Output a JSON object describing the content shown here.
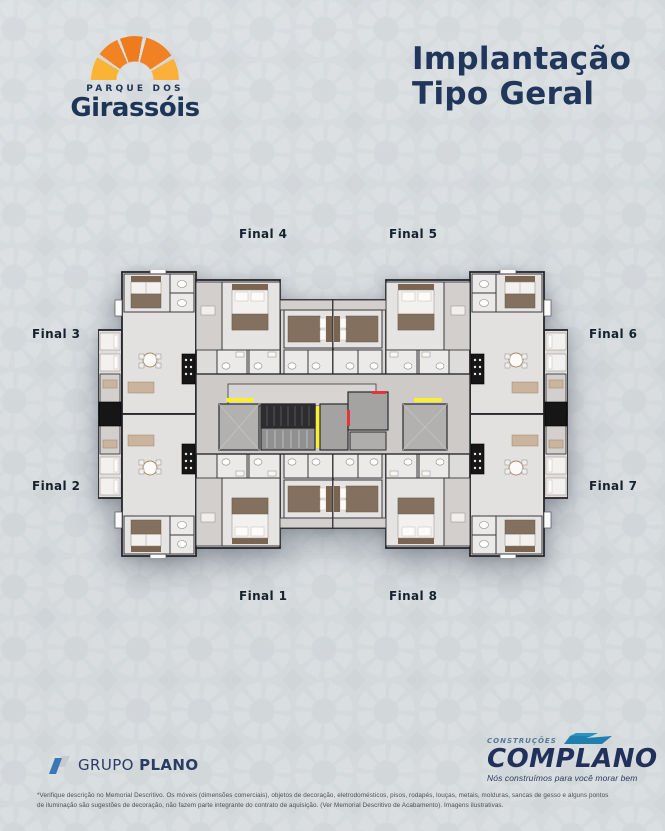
{
  "brand": {
    "top_label": "PARQUE DOS",
    "name": "Girassóis"
  },
  "title": {
    "line1": "Implantação",
    "line2": "Tipo Geral"
  },
  "plan_labels": {
    "final1": "Final 1",
    "final2": "Final 2",
    "final3": "Final 3",
    "final4": "Final 4",
    "final5": "Final 5",
    "final6": "Final 6",
    "final7": "Final 7",
    "final8": "Final 8"
  },
  "footer": {
    "grupo_plano": {
      "word1": "GRUPO",
      "word2": "PLANO"
    },
    "complano": {
      "small": "CONSTRUÇÕES",
      "name": "COMPLANO",
      "tagline": "Nós construímos para você morar bem"
    }
  },
  "disclaimer": {
    "line1": "*Verifique descrição no Memorial Descritivo. Os móveis (dimensões comerciais), objetos de decoração, eletrodomésticos, pisos, rodapés, louças, metais, molduras, sancas de gesso e alguns pontos",
    "line2": "de iluminação são sugestões de decoração, não fazem parte integrante do contrato de aquisição. (Ver Memorial Descritivo de Acabamento). Imagens ilustrativas."
  },
  "colors": {
    "navy": "#20365a",
    "brand_orange": "#f08124",
    "brand_yellow": "#f9b335",
    "teal": "#1f7fae",
    "grupo_plano_blue": "#3a77b8",
    "safety_yellow": "#f9ee32",
    "safety_red": "#e6343c",
    "background": "#d7dcdf"
  }
}
